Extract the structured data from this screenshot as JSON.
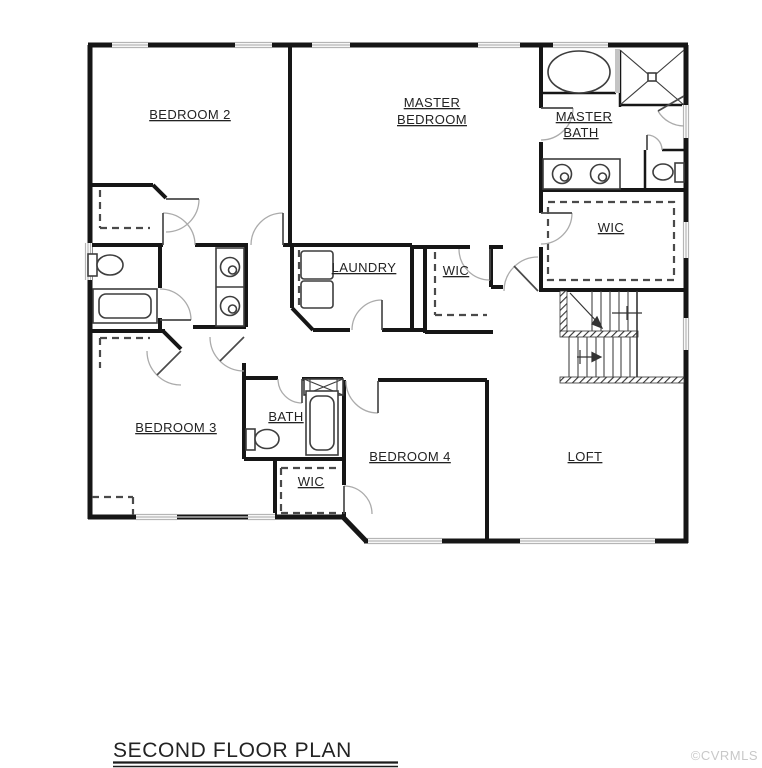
{
  "title": {
    "text": "SECOND FLOOR PLAN"
  },
  "watermark": "©CVRMLS",
  "rooms": {
    "bedroom2": "BEDROOM 2",
    "master_bedroom_line1": "MASTER",
    "master_bedroom_line2": "BEDROOM",
    "master_bath_line1": "MASTER",
    "master_bath_line2": "BATH",
    "wic_master": "WIC",
    "laundry": "LAUNDRY",
    "wic_center": "WIC",
    "bedroom3": "BEDROOM 3",
    "bath": "BATH",
    "wic_lower": "WIC",
    "bedroom4": "BEDROOM 4",
    "loft": "LOFT"
  },
  "colors": {
    "wall": "#161616",
    "fixture": "#3d3d3d",
    "door_arc": "#ababab",
    "door_leaf": "#4a4a4a",
    "window": "#b5b5b5",
    "dash": "#4a4a4a",
    "label": "#232323",
    "watermark": "#c8c8c8"
  }
}
